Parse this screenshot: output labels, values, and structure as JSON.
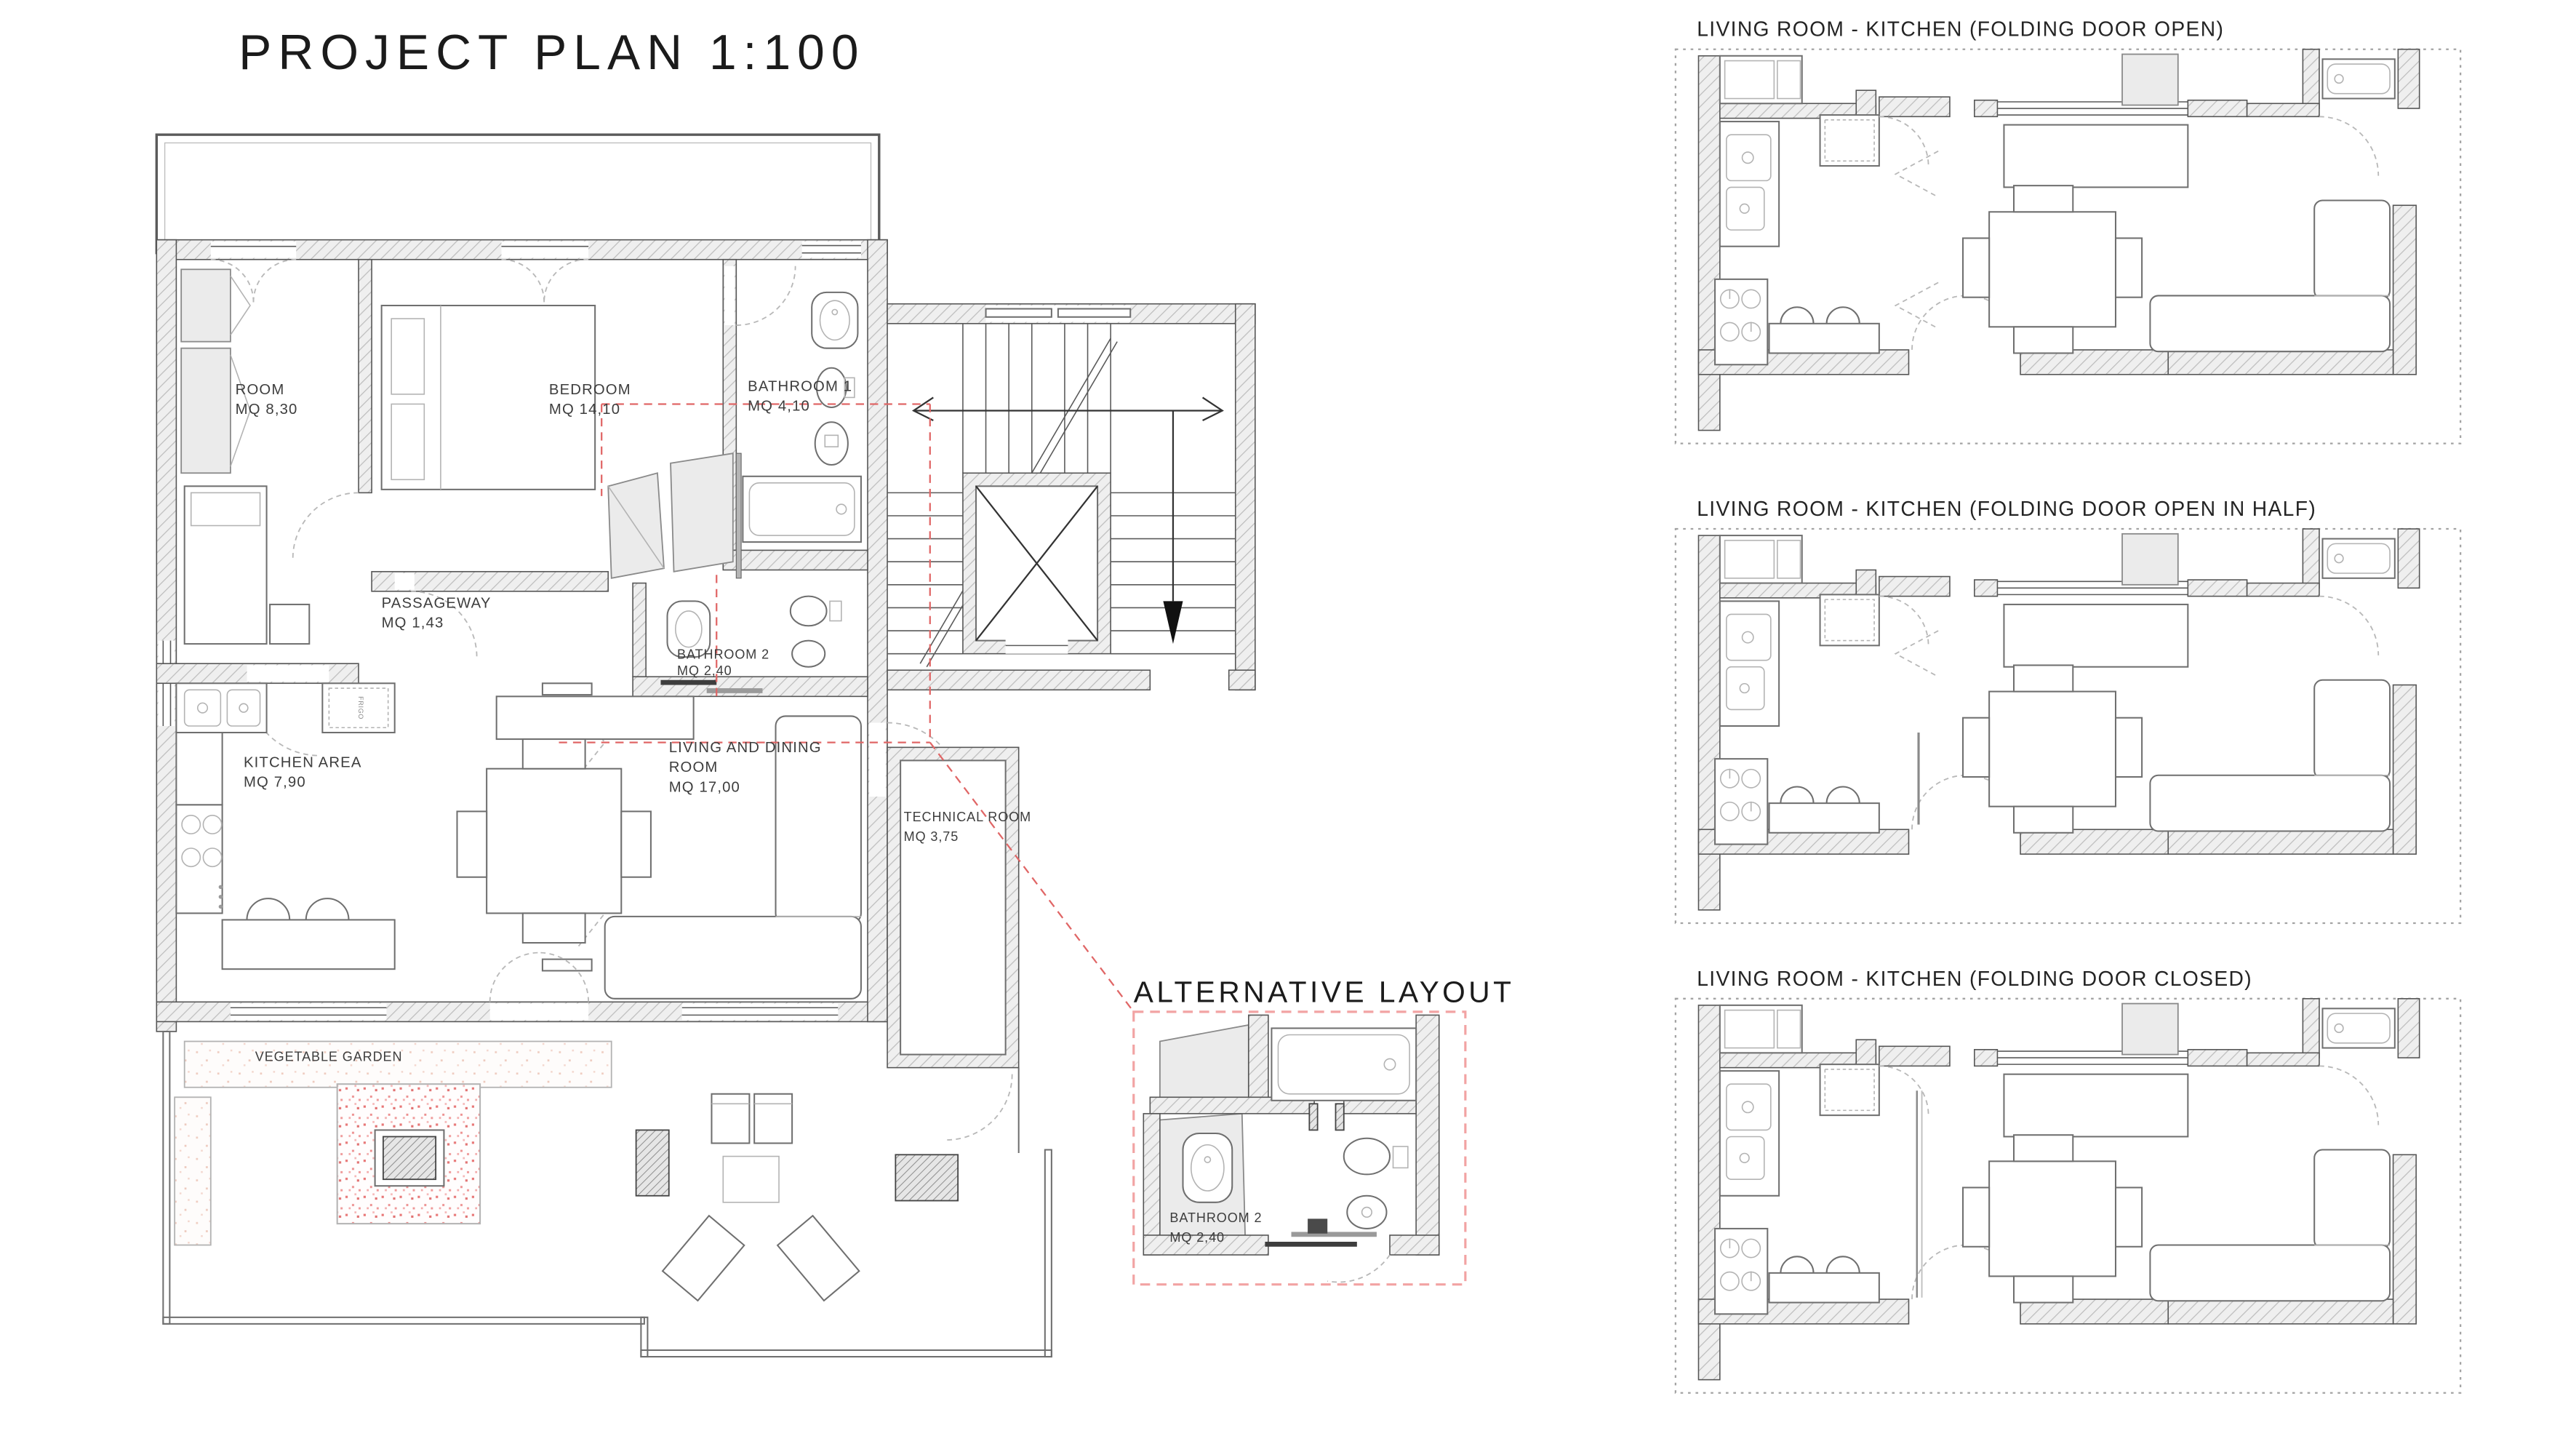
{
  "title": "PROJECT PLAN 1:100",
  "colors": {
    "wall_hatch": "#bdbdbd",
    "wall_fill": "#efefef",
    "line_dark": "#555555",
    "guide_red": "#e06666",
    "alt_border_pink": "#f2a3a3",
    "garden_speckle": "#e25555",
    "planter_speckle": "#eec7ba"
  },
  "main_plan": {
    "scale": "1:100",
    "labels": {
      "room": {
        "name": "ROOM",
        "area": "MQ 8,30"
      },
      "bedroom": {
        "name": "BEDROOM",
        "area": "MQ 14,10"
      },
      "bathroom1": {
        "name": "BATHROOM 1",
        "area": "MQ 4,10"
      },
      "passageway": {
        "name": "PASSAGEWAY",
        "area": "MQ 1,43"
      },
      "bathroom2": {
        "name": "BATHROOM 2",
        "area": "MQ 2,40"
      },
      "kitchen": {
        "name": "KITCHEN AREA",
        "area": "MQ 7,90"
      },
      "living": {
        "line1": "LIVING AND DINING",
        "line2": "ROOM",
        "area": "MQ 17,00"
      },
      "technical": {
        "name": "TECHNICAL ROOM",
        "area": "MQ 3,75"
      },
      "garden": {
        "name": "VEGETABLE GARDEN"
      }
    },
    "kitchen": {
      "fridge_label": "FRIGO"
    }
  },
  "alternative_layout": {
    "title": "ALTERNATIVE LAYOUT",
    "bathroom2": {
      "name": "BATHROOM 2",
      "area": "MQ 2,40"
    }
  },
  "detail_views": [
    {
      "title": "LIVING ROOM - KITCHEN (FOLDING DOOR OPEN)"
    },
    {
      "title": "LIVING ROOM - KITCHEN (FOLDING DOOR OPEN IN HALF)"
    },
    {
      "title": "LIVING ROOM - KITCHEN (FOLDING DOOR CLOSED)"
    }
  ]
}
